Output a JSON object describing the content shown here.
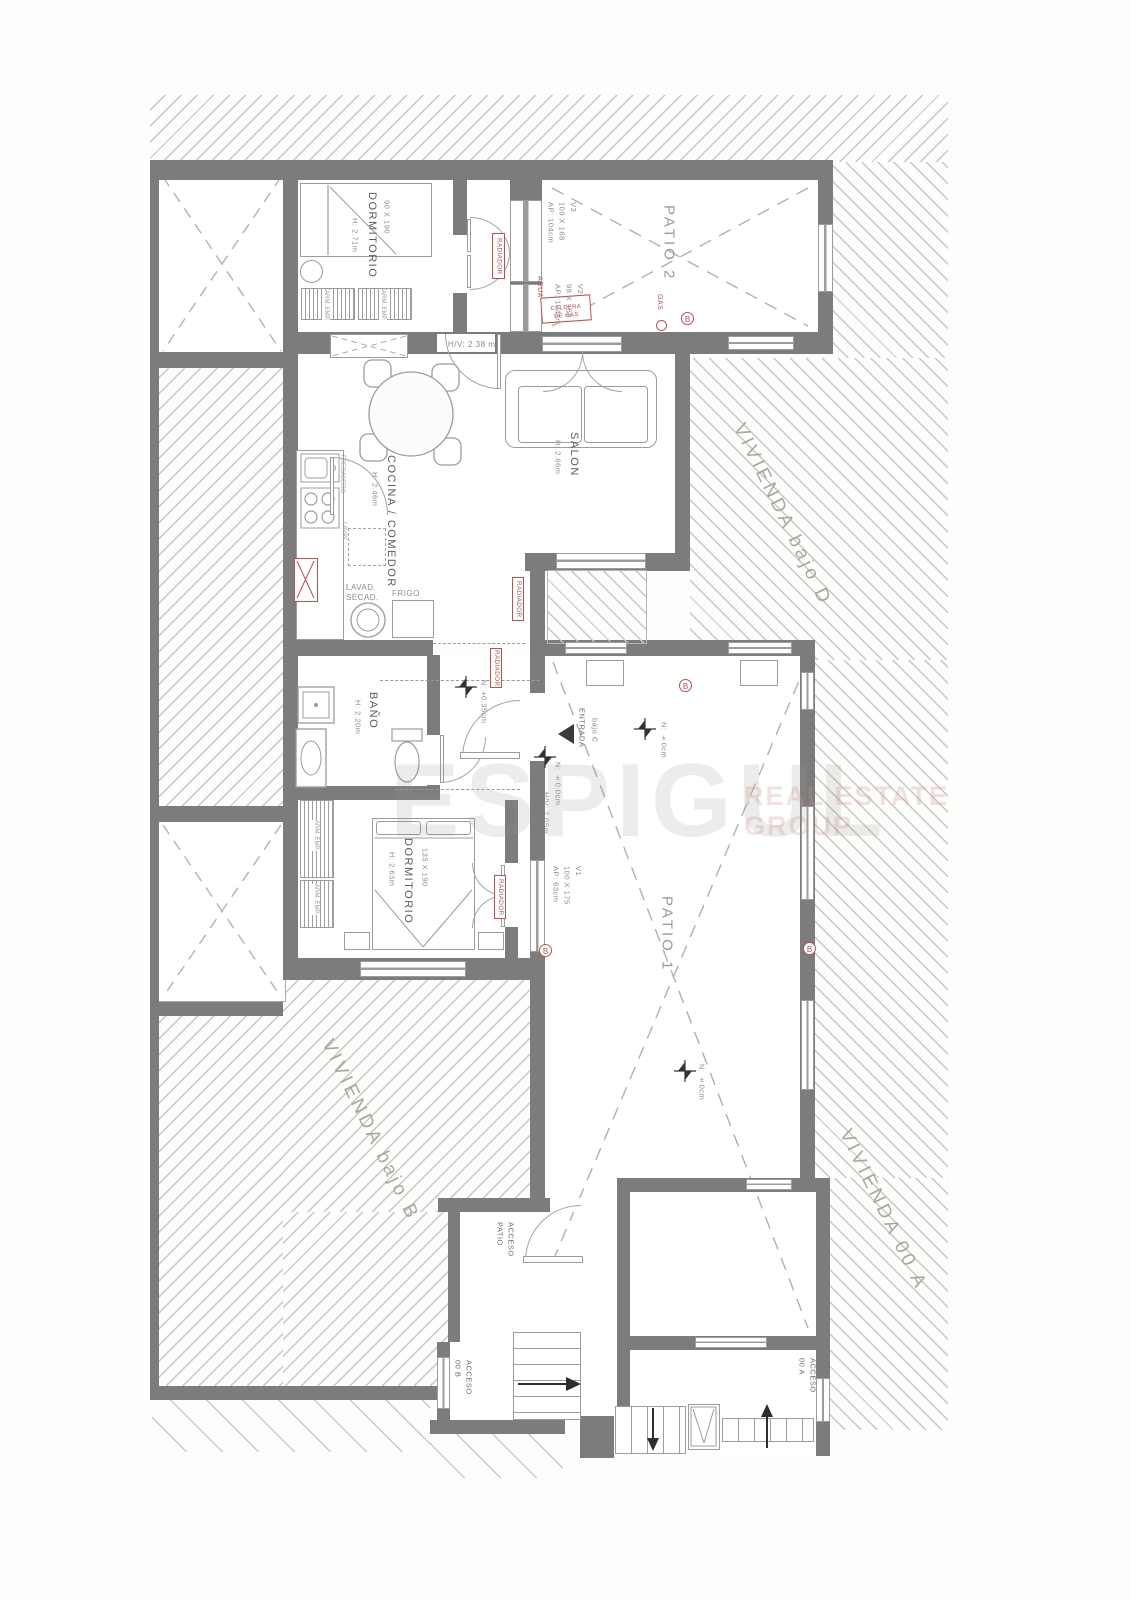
{
  "watermark": {
    "brand": "ESPIGUL",
    "tagline": "REAL ESTATE\nGROUP"
  },
  "neighbors": {
    "bajo_d": "VIVIENDA bajo D",
    "bajo_b": "VIVIENDA bajo B",
    "unit_a": "VIVIENDA 00 A"
  },
  "rooms": {
    "dormitorio1": {
      "name": "DORMITORIO",
      "size": "90 X 190",
      "height": "H: 2.71m"
    },
    "patio2": {
      "name": "PATIO 2"
    },
    "cocina": {
      "name": "COCINA / COMEDOR",
      "height": "H: 2.46m"
    },
    "salon": {
      "name": "SALON",
      "height": "H: 2.66m"
    },
    "bano": {
      "name": "BAÑO",
      "height": "H: 2.20m"
    },
    "dormitorio2": {
      "name": "DORMITORIO",
      "size": "135 X 190",
      "height": "H: 2.63m"
    },
    "patio1": {
      "name": "PATIO 1"
    }
  },
  "windows": {
    "v1": "V1\n100 X 175\nAP: 63cm",
    "v2": "V2\n98 X 168\nAP: 104cm",
    "v3": "V3\n109 X 168\nAP: 104cm"
  },
  "fixtures": {
    "radiador": "RADIADOR",
    "caldera": "CALDERA\nDE GAS",
    "agua": "AGUA",
    "gas": "GAS",
    "fregadero": "FREGADERO",
    "lavavajillas": "LAVAV.",
    "lavadora": "LAVAD.",
    "secadora": "SECAD.",
    "frigo": "FRIGO",
    "armario": "ARM. EMP.",
    "marker": "B"
  },
  "doors": {
    "entrada": "ENTRADA",
    "entrada_unit": "bajo C",
    "acceso_patio": "ACCESO\nPATIO",
    "acceso_b": "ACCESO\n00 B",
    "acceso_a": "ACCESO\n00 A",
    "clearance_hall": "H/V: 2.38 m",
    "clearance_entrada": "H/V: 2.05m"
  },
  "levels": {
    "hall": "N: +0.35cm",
    "entrada": "N: ±0.0cm",
    "patio1_top": "N: ±0cm",
    "patio1_bottom": "N: ±0cm"
  }
}
